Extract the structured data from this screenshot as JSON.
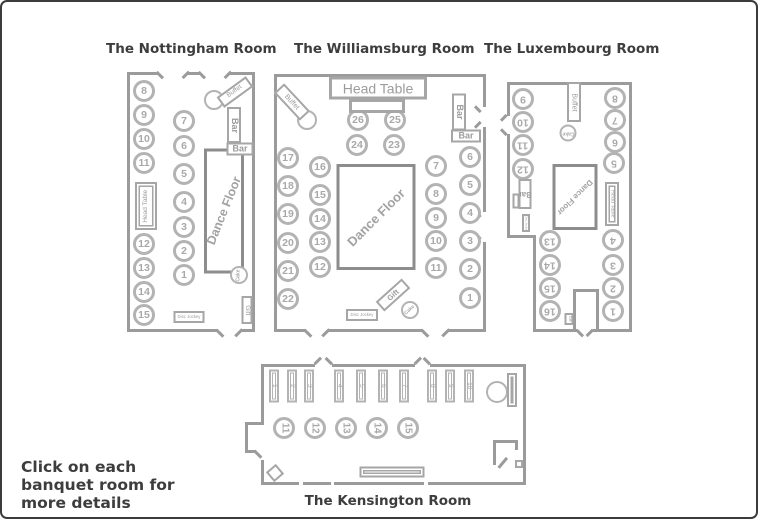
{
  "instruction": "Click on each banquet room for more details",
  "colors": {
    "wall": "#9b9b9b",
    "table_border": "#b3b3b3",
    "table_number": "#a9a9a9",
    "label_border": "#a6a6a6",
    "label_text": "#9c9c9c",
    "dance_border": "#8d8d8d",
    "dance_text": "#a2a2a2",
    "title_text": "#3d3d3d"
  },
  "rooms": [
    {
      "id": "nottingham",
      "title": "The Nottingham Room",
      "title_box": [
        104,
        39,
        160
      ],
      "origin": [
        123,
        62
      ],
      "size": [
        136,
        280
      ],
      "num_fs": 10.5,
      "num_rot": 0,
      "walls": [
        [
          125,
          70,
          3,
          260
        ],
        [
          125,
          70,
          31,
          3
        ],
        [
          186,
          70,
          12,
          3
        ],
        [
          228,
          70,
          25,
          3
        ],
        [
          250,
          70,
          3,
          260
        ],
        [
          125,
          327,
          90,
          3
        ],
        [
          240,
          327,
          13,
          3
        ]
      ],
      "ticks": [
        [
          158,
          73,
          9,
          45
        ],
        [
          184,
          73,
          9,
          135
        ],
        [
          200,
          73,
          9,
          45
        ],
        [
          226,
          73,
          9,
          135
        ],
        [
          218,
          331,
          10,
          45
        ],
        [
          237,
          331,
          10,
          135
        ]
      ],
      "tables": [
        {
          "n": "8",
          "x": 142,
          "y": 89
        },
        {
          "n": "9",
          "x": 142,
          "y": 113
        },
        {
          "n": "10",
          "x": 142,
          "y": 137
        },
        {
          "n": "11",
          "x": 142,
          "y": 161
        },
        {
          "n": "12",
          "x": 142,
          "y": 242
        },
        {
          "n": "13",
          "x": 142,
          "y": 266
        },
        {
          "n": "14",
          "x": 142,
          "y": 290
        },
        {
          "n": "15",
          "x": 142,
          "y": 313
        },
        {
          "n": "7",
          "x": 182,
          "y": 119
        },
        {
          "n": "6",
          "x": 182,
          "y": 144
        },
        {
          "n": "5",
          "x": 182,
          "y": 172
        },
        {
          "n": "4",
          "x": 182,
          "y": 200
        },
        {
          "n": "3",
          "x": 182,
          "y": 225
        },
        {
          "n": "2",
          "x": 182,
          "y": 249
        },
        {
          "n": "1",
          "x": 182,
          "y": 273
        }
      ],
      "circles": [
        {
          "name": "buffet-circle",
          "x": 212,
          "y": 98,
          "r": 10
        },
        {
          "name": "cake-table",
          "text": "Cake",
          "x": 237,
          "y": 273,
          "r": 9,
          "trot": -90,
          "fs": 5
        }
      ],
      "dance": {
        "text": "Dance Floor",
        "x": 222,
        "y": 209,
        "w": 40,
        "h": 125,
        "rot": -68,
        "fs": 12.5
      },
      "boxes": [
        {
          "name": "head-table",
          "text": "Head Table",
          "x": 144,
          "y": 204,
          "w": 22,
          "h": 48,
          "trot": -90,
          "fs": 6.5,
          "double": true
        },
        {
          "name": "buffet-label",
          "text": "Buffet",
          "x": 233,
          "y": 90,
          "w": 36,
          "h": 13,
          "brot": -36,
          "fs": 6.5
        },
        {
          "name": "bar-label-upper",
          "text": "Bar",
          "x": 232,
          "y": 123,
          "w": 14,
          "h": 36,
          "trot": 90,
          "fs": 9,
          "bold": true
        },
        {
          "name": "bar-label-lower",
          "text": "Bar",
          "x": 238,
          "y": 147,
          "w": 27,
          "h": 13,
          "fs": 9,
          "bold": true
        },
        {
          "name": "gift-table",
          "text": "Gift",
          "x": 245,
          "y": 308,
          "w": 11,
          "h": 28,
          "trot": 90,
          "fs": 6.5
        },
        {
          "name": "disc-jockey-booth",
          "text": "Disc Jockey",
          "x": 187,
          "y": 315,
          "w": 31,
          "h": 12,
          "fs": 4.3
        }
      ]
    },
    {
      "id": "williamsburg",
      "title": "The Williamsburg Room",
      "title_box": [
        292,
        39,
        168
      ],
      "origin": [
        270,
        62
      ],
      "size": [
        218,
        278
      ],
      "num_fs": 10.5,
      "num_rot": 0,
      "walls": [
        [
          272,
          72,
          3,
          258
        ],
        [
          272,
          72,
          212,
          3
        ],
        [
          481,
          72,
          3,
          33
        ],
        [
          481,
          125,
          3,
          85
        ],
        [
          481,
          240,
          3,
          90
        ],
        [
          272,
          327,
          31,
          3
        ],
        [
          327,
          327,
          93,
          3
        ],
        [
          447,
          327,
          37,
          3
        ]
      ],
      "ticks": [
        [
          306,
          331,
          10,
          45
        ],
        [
          324,
          331,
          10,
          135
        ],
        [
          423,
          331,
          10,
          45
        ],
        [
          444,
          331,
          10,
          135
        ],
        [
          476,
          107,
          8,
          45
        ],
        [
          476,
          123,
          8,
          135
        ],
        [
          476,
          212,
          8,
          45
        ],
        [
          476,
          238,
          8,
          135
        ]
      ],
      "tables": [
        {
          "n": "17",
          "x": 286,
          "y": 156
        },
        {
          "n": "18",
          "x": 286,
          "y": 184
        },
        {
          "n": "19",
          "x": 286,
          "y": 212
        },
        {
          "n": "20",
          "x": 286,
          "y": 241
        },
        {
          "n": "21",
          "x": 286,
          "y": 269
        },
        {
          "n": "22",
          "x": 286,
          "y": 297
        },
        {
          "n": "16",
          "x": 318,
          "y": 165
        },
        {
          "n": "15",
          "x": 318,
          "y": 193
        },
        {
          "n": "14",
          "x": 318,
          "y": 217
        },
        {
          "n": "13",
          "x": 318,
          "y": 240
        },
        {
          "n": "12",
          "x": 318,
          "y": 265
        },
        {
          "n": "26",
          "x": 356,
          "y": 118
        },
        {
          "n": "25",
          "x": 393,
          "y": 118
        },
        {
          "n": "24",
          "x": 355,
          "y": 143
        },
        {
          "n": "23",
          "x": 392,
          "y": 143
        },
        {
          "n": "7",
          "x": 434,
          "y": 164
        },
        {
          "n": "8",
          "x": 434,
          "y": 192
        },
        {
          "n": "9",
          "x": 434,
          "y": 216
        },
        {
          "n": "10",
          "x": 434,
          "y": 239
        },
        {
          "n": "11",
          "x": 434,
          "y": 266
        },
        {
          "n": "6",
          "x": 468,
          "y": 155
        },
        {
          "n": "5",
          "x": 468,
          "y": 183
        },
        {
          "n": "4",
          "x": 468,
          "y": 211
        },
        {
          "n": "3",
          "x": 468,
          "y": 239
        },
        {
          "n": "2",
          "x": 468,
          "y": 267
        },
        {
          "n": "1",
          "x": 468,
          "y": 296
        }
      ],
      "circles": [
        {
          "name": "buffet-circle",
          "x": 305,
          "y": 118,
          "r": 10
        },
        {
          "name": "cake-table",
          "text": "Cake",
          "x": 408,
          "y": 308,
          "r": 9,
          "trot": -42,
          "fs": 5
        }
      ],
      "dance": {
        "text": "Dance Floor",
        "x": 374,
        "y": 215,
        "w": 79,
        "h": 106,
        "rot": -45,
        "fs": 13
      },
      "boxes": [
        {
          "name": "head-table",
          "text": "Head Table",
          "x": 376,
          "y": 86,
          "w": 98,
          "h": 23,
          "fs": 14,
          "thick": true
        },
        {
          "name": "head-table-front",
          "x": 375,
          "y": 104,
          "w": 56,
          "h": 14,
          "thick": true
        },
        {
          "name": "buffet-label",
          "text": "Buffet",
          "x": 290,
          "y": 100,
          "w": 38,
          "h": 14,
          "brot": 47,
          "fs": 7
        },
        {
          "name": "bar-label-upper",
          "text": "Bar",
          "x": 457,
          "y": 110,
          "w": 14,
          "h": 37,
          "trot": 90,
          "fs": 9,
          "bold": true
        },
        {
          "name": "bar-label-lower",
          "text": "Bar",
          "x": 464,
          "y": 134,
          "w": 30,
          "h": 13,
          "fs": 9,
          "bold": true
        },
        {
          "name": "gift-table",
          "text": "Gift",
          "x": 391,
          "y": 293,
          "w": 35,
          "h": 13,
          "brot": -42,
          "fs": 7.5,
          "bold": true
        },
        {
          "name": "disc-jockey-booth",
          "text": "Disc Jockey",
          "x": 360,
          "y": 313,
          "w": 32,
          "h": 12,
          "fs": 4.3
        }
      ]
    },
    {
      "id": "luxembourg",
      "title": "The Luxembourg Room",
      "title_box": [
        482,
        39,
        166
      ],
      "origin": [
        498,
        70
      ],
      "size": [
        136,
        272
      ],
      "num_fs": 10.5,
      "num_rot": 180,
      "walls": [
        [
          505,
          80,
          125,
          3
        ],
        [
          505,
          80,
          3,
          34
        ],
        [
          505,
          132,
          3,
          103
        ],
        [
          505,
          233,
          29,
          3
        ],
        [
          531,
          233,
          3,
          97
        ],
        [
          627,
          80,
          3,
          250
        ],
        [
          531,
          327,
          44,
          3
        ],
        [
          591,
          327,
          39,
          3
        ],
        [
          571,
          287,
          3,
          41
        ],
        [
          594,
          287,
          3,
          41
        ],
        [
          571,
          287,
          26,
          3
        ]
      ],
      "ticks": [
        [
          502,
          116,
          8,
          135
        ],
        [
          502,
          130,
          8,
          45
        ],
        [
          578,
          331,
          9,
          45
        ],
        [
          588,
          331,
          9,
          135
        ]
      ],
      "tables": [
        {
          "n": "9",
          "x": 521,
          "y": 97
        },
        {
          "n": "10",
          "x": 521,
          "y": 120
        },
        {
          "n": "11",
          "x": 521,
          "y": 143
        },
        {
          "n": "12",
          "x": 521,
          "y": 167
        },
        {
          "n": "13",
          "x": 548,
          "y": 239
        },
        {
          "n": "14",
          "x": 548,
          "y": 263
        },
        {
          "n": "15",
          "x": 548,
          "y": 286
        },
        {
          "n": "16",
          "x": 548,
          "y": 309
        },
        {
          "n": "8",
          "x": 613,
          "y": 96
        },
        {
          "n": "7",
          "x": 613,
          "y": 118
        },
        {
          "n": "6",
          "x": 613,
          "y": 140
        },
        {
          "n": "5",
          "x": 612,
          "y": 161
        },
        {
          "n": "4",
          "x": 611,
          "y": 238
        },
        {
          "n": "3",
          "x": 611,
          "y": 263
        },
        {
          "n": "2",
          "x": 611,
          "y": 286
        },
        {
          "n": "1",
          "x": 611,
          "y": 309
        }
      ],
      "circles": [
        {
          "name": "cake-table",
          "text": "Cake",
          "x": 566,
          "y": 131,
          "r": 8.5,
          "trot": 180,
          "fs": 5
        }
      ],
      "dance": {
        "text": "Dance Floor",
        "x": 573,
        "y": 195,
        "w": 45,
        "h": 66,
        "rot": 135,
        "fs": 8
      },
      "boxes": [
        {
          "name": "buffet-table",
          "text": "Buffet",
          "x": 572,
          "y": 100,
          "w": 14,
          "h": 40,
          "trot": 90,
          "fs": 7
        },
        {
          "name": "head-table",
          "text": "Head Table",
          "x": 610,
          "y": 202,
          "w": 14,
          "h": 44,
          "trot": 90,
          "fs": 5.5,
          "double": true
        },
        {
          "name": "bar-label",
          "text": "Bar",
          "x": 523,
          "y": 192,
          "w": 13,
          "h": 30,
          "trot": 180,
          "fs": 8,
          "bold": true
        },
        {
          "name": "bar-side",
          "x": 514,
          "y": 199,
          "w": 7,
          "h": 15
        },
        {
          "name": "disc-jockey-booth",
          "text": "Disc Jockey",
          "x": 524,
          "y": 221,
          "w": 8,
          "h": 18,
          "trot": 90,
          "fs": 3,
          "clip": true
        },
        {
          "name": "gift-table",
          "text": "Gift",
          "x": 567,
          "y": 317,
          "w": 9,
          "h": 12,
          "trot": 90,
          "fs": 3.5,
          "clip": true
        }
      ]
    },
    {
      "id": "kensington",
      "title": "The Kensington Room",
      "title_box": [
        302,
        491,
        168
      ],
      "origin": [
        240,
        352
      ],
      "size": [
        288,
        136
      ],
      "num_fs": 10,
      "num_rot": 90,
      "rect_fs": 6.5,
      "walls": [
        [
          259,
          362,
          54,
          3
        ],
        [
          330,
          362,
          83,
          3
        ],
        [
          428,
          362,
          96,
          3
        ],
        [
          521,
          362,
          3,
          121
        ],
        [
          259,
          480,
          38,
          3
        ],
        [
          301,
          480,
          28,
          3
        ],
        [
          332,
          480,
          90,
          3
        ],
        [
          426,
          480,
          98,
          3
        ],
        [
          259,
          362,
          3,
          60
        ],
        [
          243,
          420,
          19,
          3
        ],
        [
          243,
          420,
          3,
          31
        ],
        [
          243,
          448,
          11,
          3
        ],
        [
          259,
          458,
          3,
          25
        ],
        [
          491,
          438,
          3,
          25
        ],
        [
          491,
          438,
          25,
          3
        ],
        [
          513,
          438,
          3,
          10
        ]
      ],
      "ticks": [
        [
          316,
          359,
          9,
          135
        ],
        [
          327,
          359,
          9,
          45
        ],
        [
          416,
          359,
          9,
          135
        ],
        [
          425,
          359,
          9,
          45
        ],
        [
          256,
          452,
          10,
          45
        ],
        [
          501,
          461,
          13,
          130
        ]
      ],
      "rect_tables": [
        {
          "n": "1",
          "x": 272,
          "y": 384
        },
        {
          "n": "2",
          "x": 290,
          "y": 384
        },
        {
          "n": "3",
          "x": 307,
          "y": 384
        },
        {
          "n": "4",
          "x": 337,
          "y": 384
        },
        {
          "n": "5",
          "x": 359,
          "y": 384
        },
        {
          "n": "6",
          "x": 381,
          "y": 384
        },
        {
          "n": "7",
          "x": 402,
          "y": 384
        },
        {
          "n": "8",
          "x": 430,
          "y": 384
        },
        {
          "n": "9",
          "x": 448,
          "y": 384
        },
        {
          "n": "10",
          "x": 467,
          "y": 384
        }
      ],
      "rect_size": [
        10,
        33
      ],
      "tables": [
        {
          "n": "11",
          "x": 282,
          "y": 426
        },
        {
          "n": "12",
          "x": 313,
          "y": 426
        },
        {
          "n": "13",
          "x": 344,
          "y": 426
        },
        {
          "n": "14",
          "x": 375,
          "y": 426
        },
        {
          "n": "15",
          "x": 406,
          "y": 426
        }
      ],
      "circles": [
        {
          "name": "buffet-circle",
          "x": 495,
          "y": 390,
          "r": 11
        }
      ],
      "boxes": [
        {
          "name": "buffet-table",
          "x": 510,
          "y": 388,
          "w": 10,
          "h": 34,
          "double": true
        },
        {
          "name": "long-table",
          "x": 390,
          "y": 470,
          "w": 65,
          "h": 11,
          "double": true
        },
        {
          "name": "tilted-table",
          "x": 273,
          "y": 471,
          "w": 13,
          "h": 13,
          "brot": -40
        },
        {
          "name": "small-square",
          "x": 517,
          "y": 462,
          "w": 8,
          "h": 8
        }
      ]
    }
  ]
}
